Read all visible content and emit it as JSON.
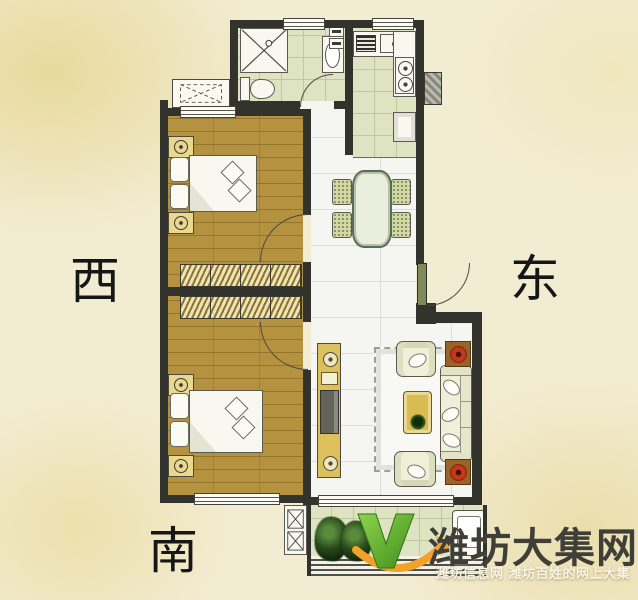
{
  "compass": {
    "west": "西",
    "east": "东",
    "south": "南"
  },
  "watermark": {
    "site_name": "潍坊大集网",
    "tagline": "潍坊信息网 潍坊百姓的网上大集",
    "logo_green": "#5cb231",
    "logo_orange": "#f2a229"
  },
  "palette": {
    "paper_background": "#f2ecd2",
    "wall": "#33332d",
    "wood_floor": "#b5923f",
    "tile_green": "#dee4c1",
    "tile_white": "#f5f6f2",
    "furniture_yellow": "#dcc05e",
    "door_green": "#7d8a5a",
    "flower_red": "#c23a1a"
  },
  "icons": [
    "shower-icon",
    "toilet-icon",
    "bath-sink-icon",
    "duct-box-icon",
    "vent-icon",
    "kitchen-sink-icon",
    "stove-icon",
    "bed-icon",
    "nightstand-icon",
    "pillow-icon",
    "wardrobe-icon",
    "window-icon",
    "door-arc-icon",
    "ac-platform-icon",
    "dining-table-icon",
    "chair-icon",
    "tv-cabinet-icon",
    "rug-icon",
    "armchair-icon",
    "coffee-table-icon",
    "sofa-icon",
    "plant-stand-icon",
    "plant-icon",
    "washing-machine-icon",
    "shaft-icon",
    "flue-icon",
    "logo-v-icon",
    "swoosh-icon"
  ]
}
